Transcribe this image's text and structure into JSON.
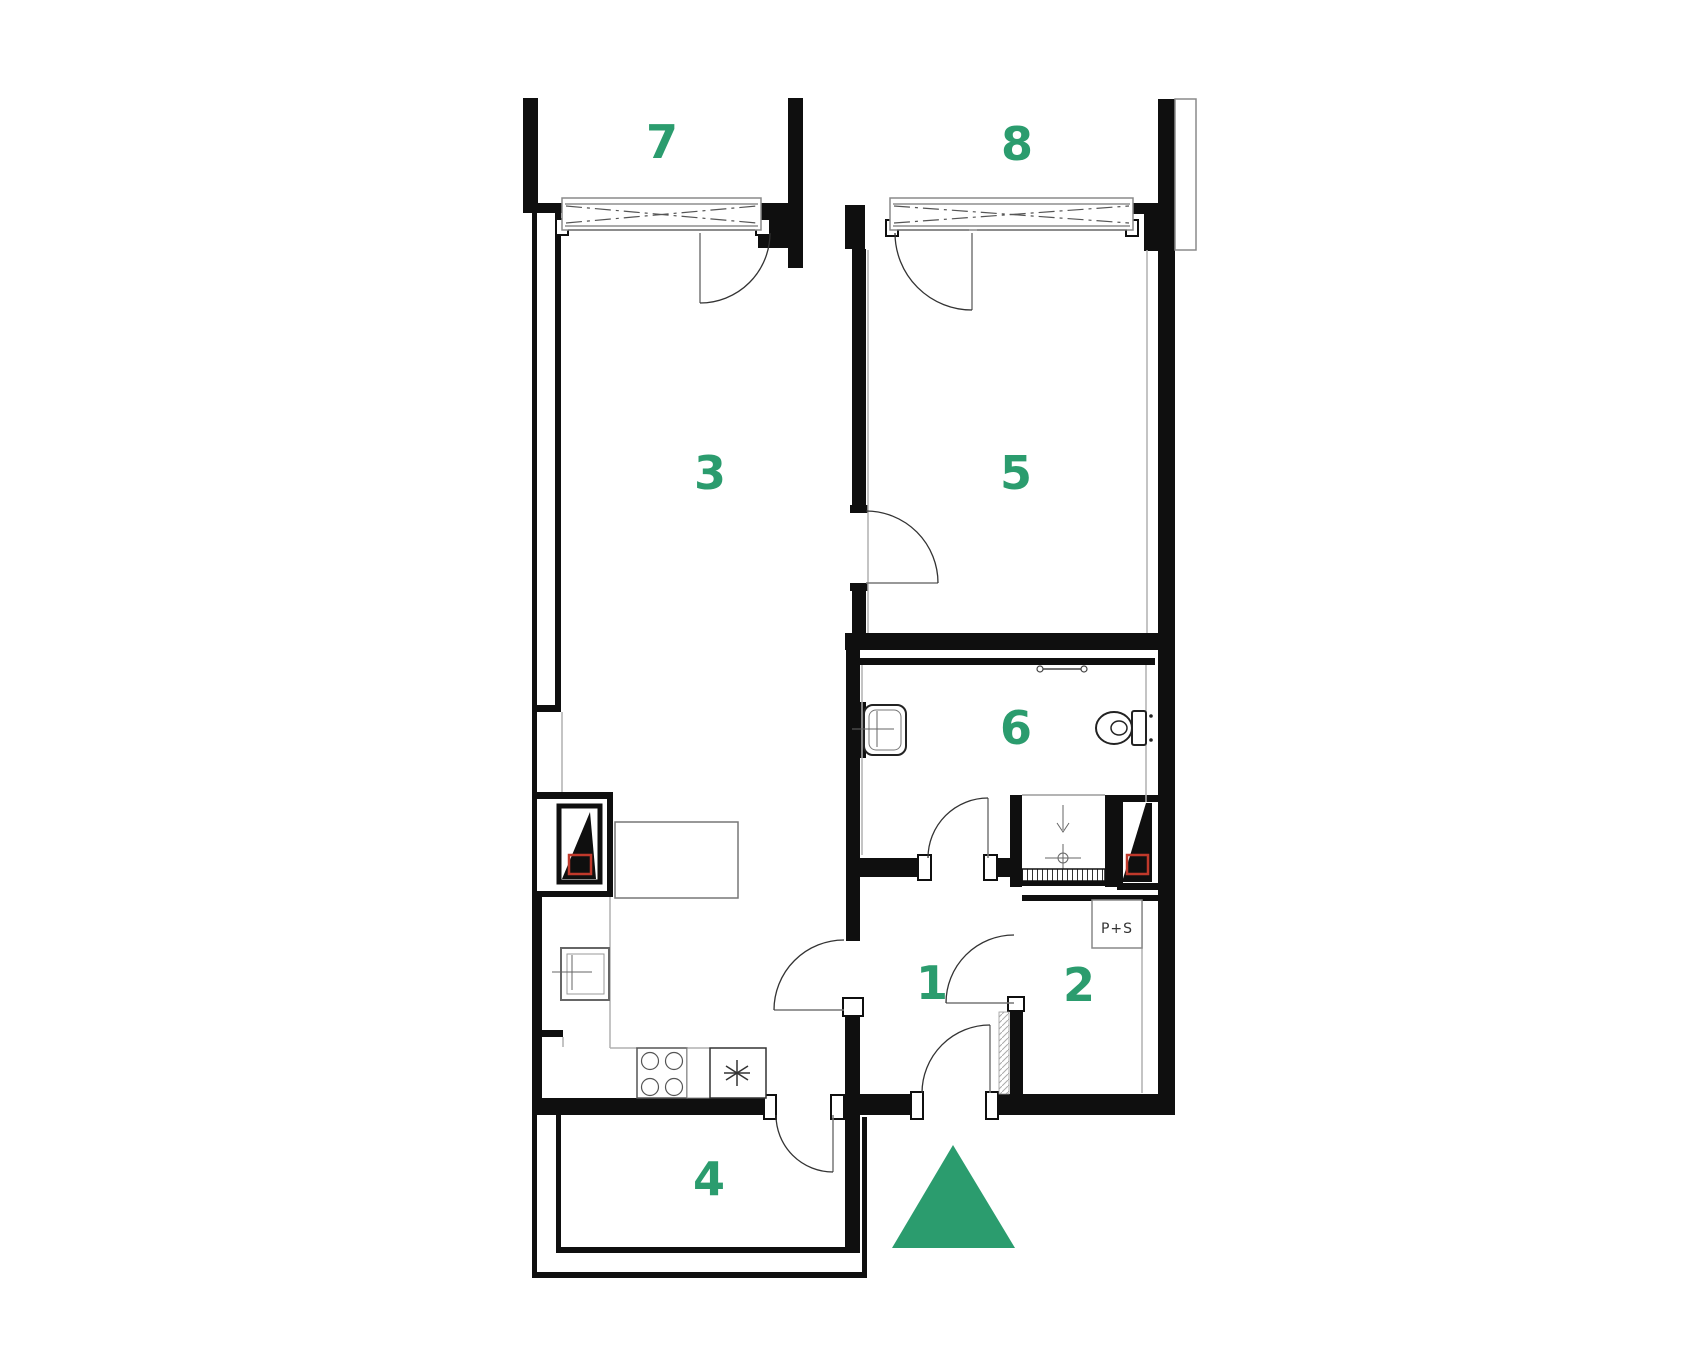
{
  "colors": {
    "accent_green": "#2b9c6e",
    "wall_black": "#0f0f0f",
    "line_gray": "#8a8a8a",
    "marker_red": "#c0392b"
  },
  "rooms": [
    {
      "label": "1"
    },
    {
      "label": "2"
    },
    {
      "label": "3"
    },
    {
      "label": "4"
    },
    {
      "label": "5"
    },
    {
      "label": "6"
    },
    {
      "label": "7"
    },
    {
      "label": "8"
    }
  ],
  "annotations": {
    "ps_label": "P+S"
  }
}
